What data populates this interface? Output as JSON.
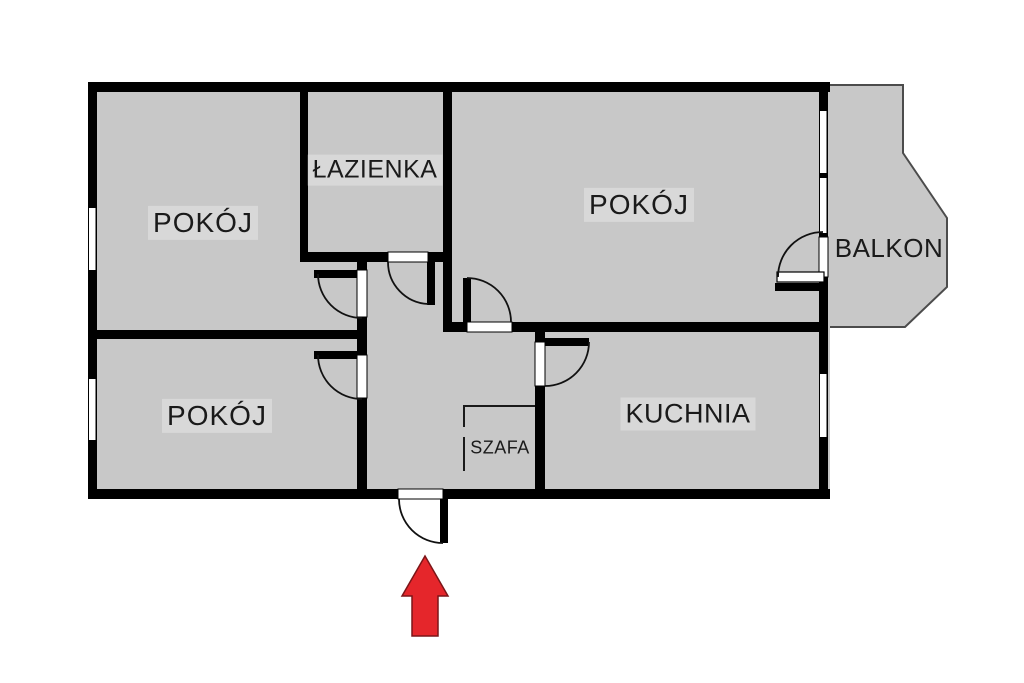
{
  "plan": {
    "type": "apartment-floor-plan",
    "rooms": {
      "pokoj_top_left": {
        "label": "POKÓJ"
      },
      "lazienka": {
        "label": "ŁAZIENKA"
      },
      "pokoj_top_right": {
        "label": "POKÓJ"
      },
      "balkon": {
        "label": "BALKON"
      },
      "pokoj_bottom_left": {
        "label": "POKÓJ"
      },
      "kuchnia": {
        "label": "KUCHNIA"
      },
      "szafa": {
        "label": "SZAFA"
      }
    },
    "colors": {
      "floor": "#c8c8c8",
      "wall": "#000000",
      "outside": "#ffffff",
      "balcony_outline": "#4c4c4c",
      "arrow_fill": "#e5262b",
      "arrow_outline": "#7c1518",
      "label_text": "#1a1a1a"
    }
  }
}
